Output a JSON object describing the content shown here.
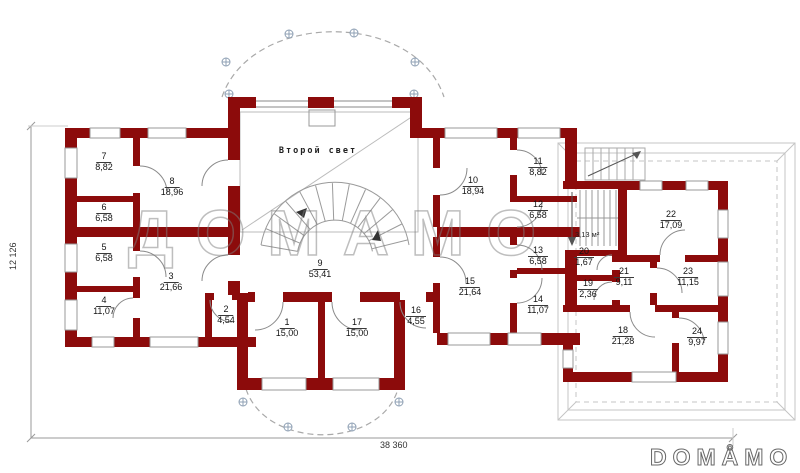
{
  "plan": {
    "watermark": "ДОМАМО",
    "logo_text": "DOMÅMO",
    "labels": {
      "second_light": "Второй свет",
      "stair_area": "3,13 м²"
    },
    "dimensions": {
      "bottom": "38 360",
      "left": "12 126"
    },
    "colors": {
      "wall": "#8C0B0B",
      "thin_line": "#999999",
      "roof_outline": "#c4c4c4",
      "text": "#141414"
    },
    "rooms": [
      {
        "number": "1",
        "area": "15,00"
      },
      {
        "number": "2",
        "area": "4,54"
      },
      {
        "number": "3",
        "area": "21,66"
      },
      {
        "number": "4",
        "area": "11,07"
      },
      {
        "number": "5",
        "area": "6,58"
      },
      {
        "number": "6",
        "area": "6,58"
      },
      {
        "number": "7",
        "area": "8,82"
      },
      {
        "number": "8",
        "area": "18,96"
      },
      {
        "number": "9",
        "area": "53,41"
      },
      {
        "number": "10",
        "area": "18,94"
      },
      {
        "number": "11",
        "area": "8,82"
      },
      {
        "number": "12",
        "area": "6,58"
      },
      {
        "number": "13",
        "area": "6,58"
      },
      {
        "number": "14",
        "area": "11,07"
      },
      {
        "number": "15",
        "area": "21,64"
      },
      {
        "number": "16",
        "area": "4,55"
      },
      {
        "number": "17",
        "area": "15,00"
      },
      {
        "number": "18",
        "area": "21,28"
      },
      {
        "number": "19",
        "area": "2,36"
      },
      {
        "number": "20",
        "area": "1,67"
      },
      {
        "number": "21",
        "area": "9,11"
      },
      {
        "number": "22",
        "area": "17,09"
      },
      {
        "number": "23",
        "area": "11,15"
      },
      {
        "number": "24",
        "area": "9,97"
      }
    ]
  }
}
